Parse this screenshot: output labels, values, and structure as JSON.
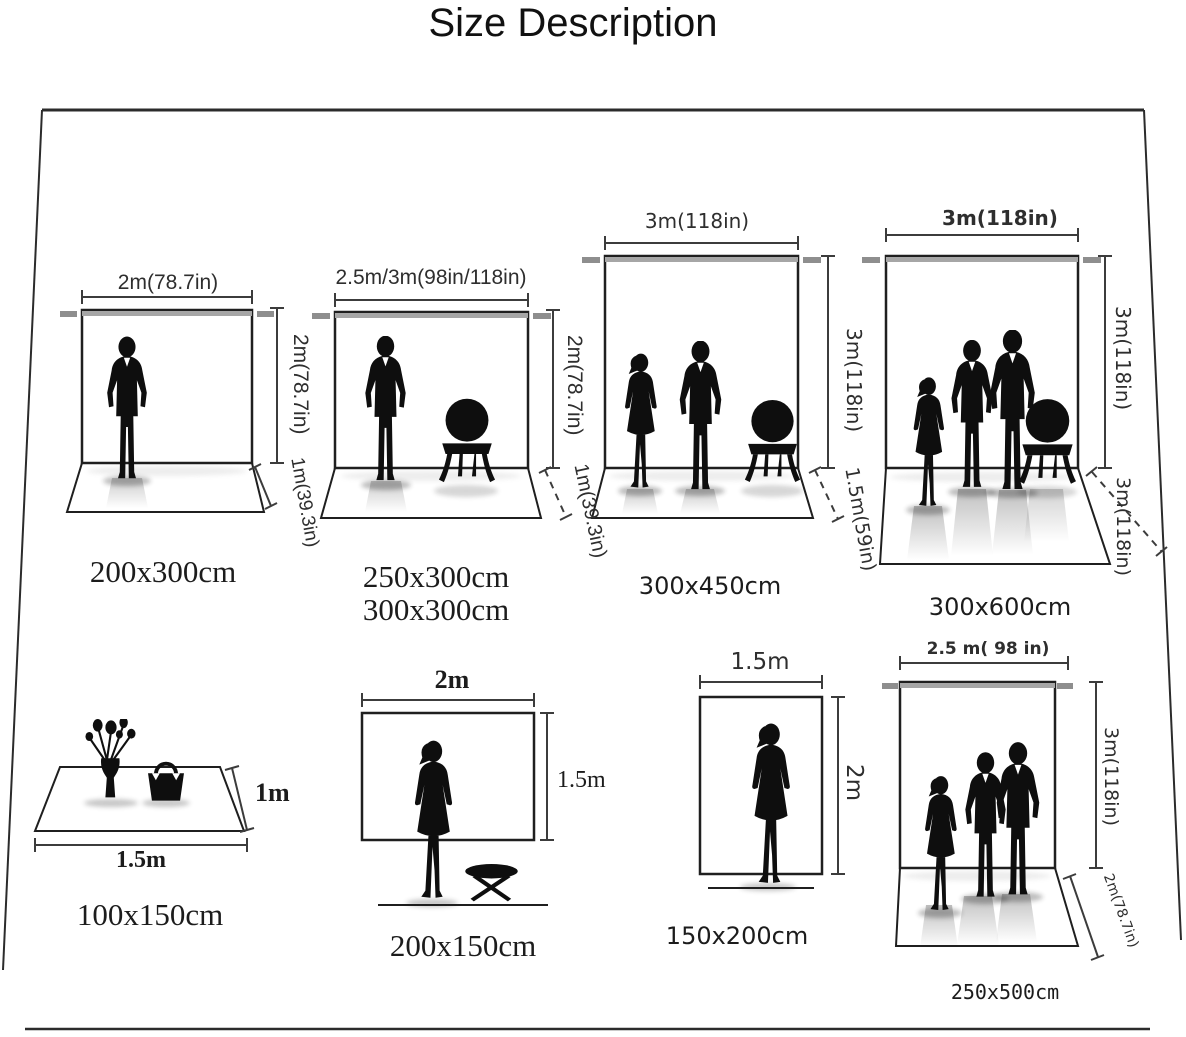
{
  "palette": {
    "ink": "#1c1c1c",
    "frame_line": "#1f1f1f",
    "crossbar_gray": "#a6a6a6",
    "cap_gray": "#8e8e8e",
    "background": "#ffffff"
  },
  "title": "Size Description",
  "backdrops": {
    "b1": {
      "width": "2m(78.7in)",
      "height": "2m(78.7in)",
      "floor": "1m(39.3in)",
      "size": "200x300cm"
    },
    "b2": {
      "width": "2.5m/3m(98in/118in)",
      "height": "2m(78.7in)",
      "floor": "1m(39.3in)",
      "size_a": "250x300cm",
      "size_b": "300x300cm"
    },
    "b3": {
      "width": "3m(118in)",
      "height": "3m(118in)",
      "floor": "1.5m(59in)",
      "size": "300x450cm"
    },
    "b4": {
      "width": "3m(118in)",
      "height": "3m(118in)",
      "floor": "3m(118in)",
      "size": "300x600cm"
    },
    "b5": {
      "depth": "1m",
      "width": "1.5m",
      "size": "100x150cm"
    },
    "b6": {
      "width": "2m",
      "height": "1.5m",
      "size": "200x150cm"
    },
    "b7": {
      "width": "1.5m",
      "height": "2m",
      "size": "150x200cm"
    },
    "b8": {
      "width": "2.5 m( 98 in)",
      "height": "3m(118in)",
      "floor": "2m(78.7in)",
      "size": "250x500cm"
    }
  }
}
